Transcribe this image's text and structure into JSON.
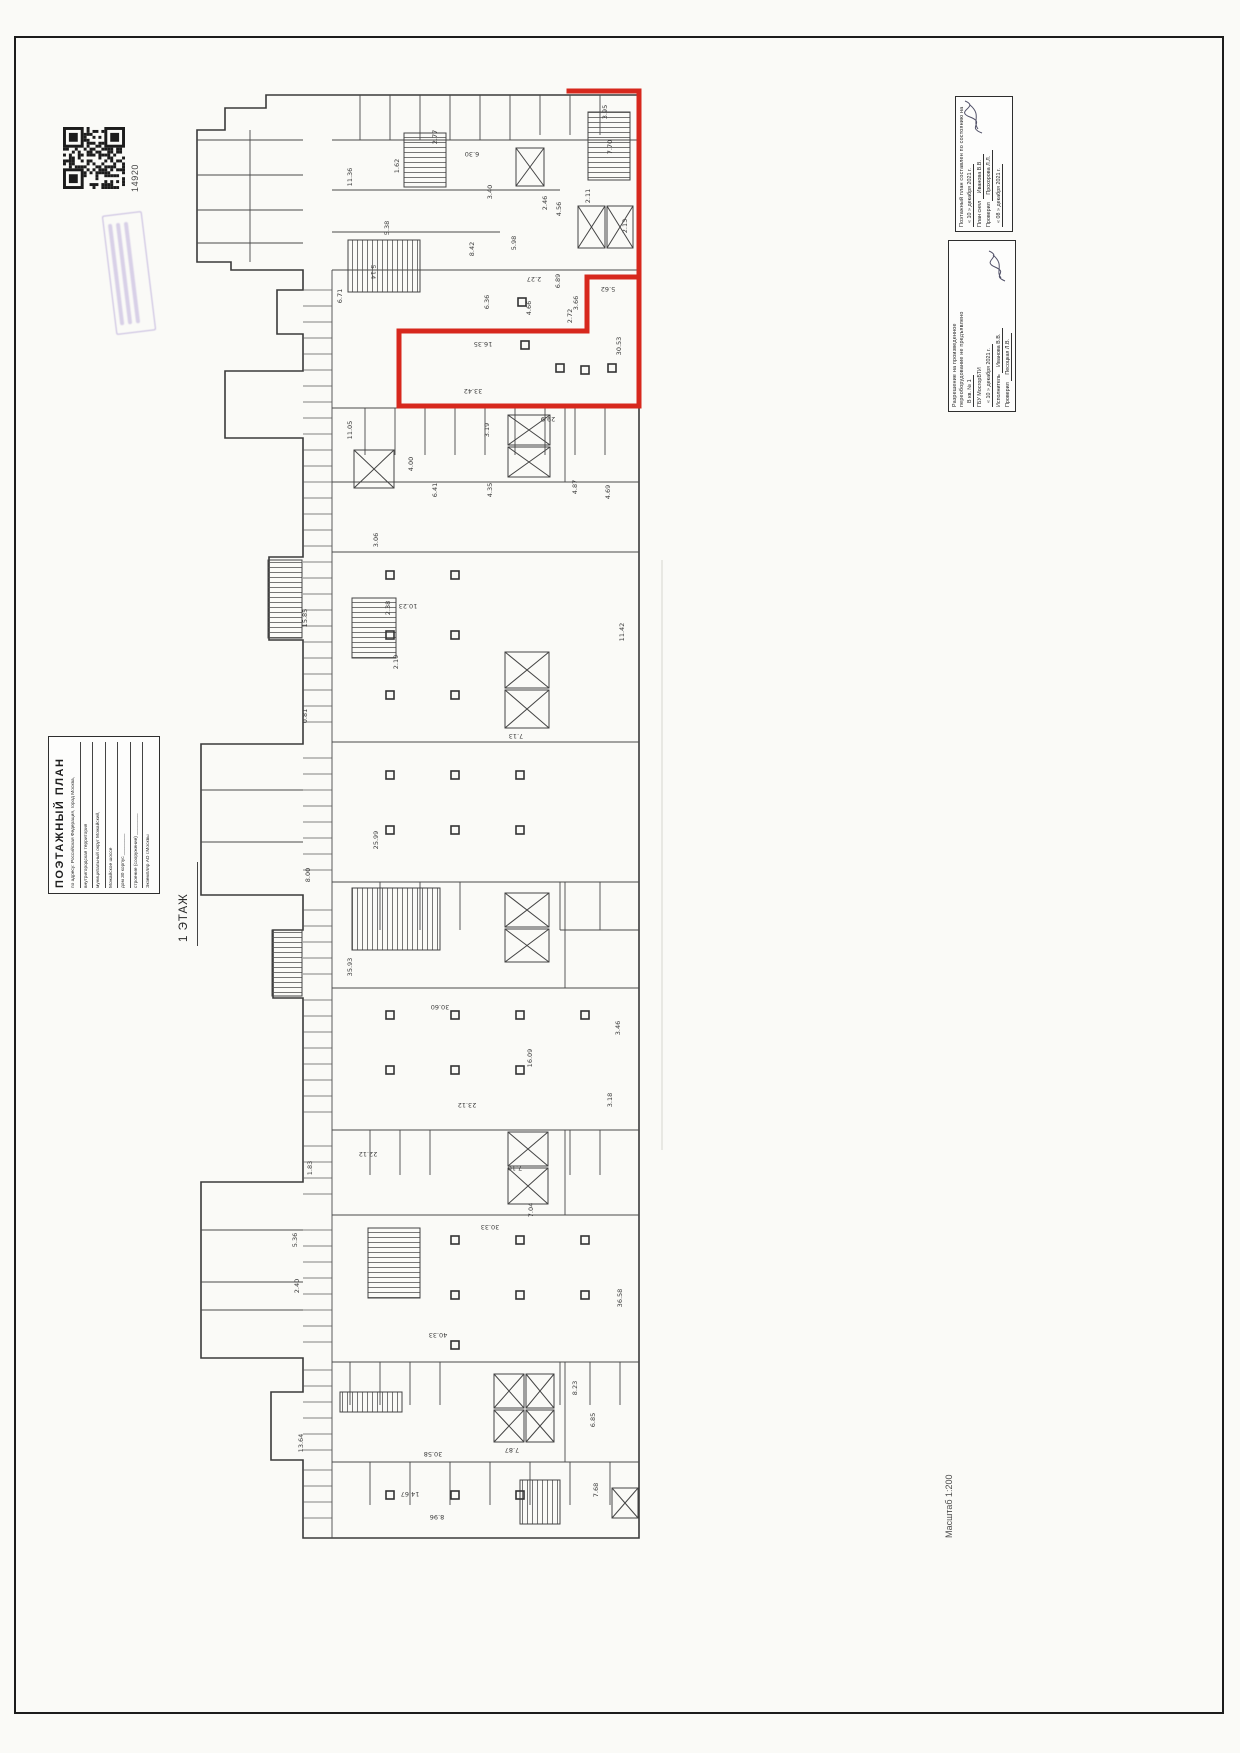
{
  "misc": {
    "barcode_number": "14920",
    "floor_label": "1 ЭТАЖ",
    "scale_label": "Масштаб 1:200"
  },
  "title_block": {
    "title": "ПОЭТАЖНЫЙ ПЛАН",
    "rows": [
      "по адресу: Российская Федерация, город Москва,",
      "внутригородская территория",
      "муниципальный округ Можайский,",
      "Можайское шоссе",
      "дом  30        корпус ________",
      "строение (сооружение) ________",
      "Экземпляр АО г.Москвы"
    ]
  },
  "survey": {
    "header": "Поэтажный план составлен по состоянию на",
    "date_line": "« 10 »  декабря  2021 г.",
    "rows": [
      {
        "label": "План снял",
        "name": "Иванова В.В."
      },
      {
        "label": "Проверил",
        "name": "Прохорова Л.Л."
      }
    ],
    "date_line2": "« 08 »  декабря  2021 г."
  },
  "permit": {
    "line1": "Разрешение на произведенное",
    "line2": "переоборудование не предъявлено",
    "line3": "В кв. № 1",
    "org": "ГБУ МосгорБТИ",
    "date_line": "« 10 »  декабря  2021 г.",
    "rows": [
      {
        "label": "Исполнитель",
        "name": "Иванова В.В."
      },
      {
        "label": "Проверил",
        "name": "Песоцкая Л.В."
      }
    ]
  },
  "plan": {
    "red_color": "#d7281d",
    "dims": [
      {
        "v": "3.95",
        "x": 607,
        "y": 112,
        "r": -90
      },
      {
        "v": "7.70",
        "x": 612,
        "y": 147,
        "r": -90
      },
      {
        "v": "2.13",
        "x": 627,
        "y": 226,
        "r": -90
      },
      {
        "v": "2.11",
        "x": 590,
        "y": 196,
        "r": -90
      },
      {
        "v": "4.56",
        "x": 561,
        "y": 209,
        "r": -90
      },
      {
        "v": "2.46",
        "x": 547,
        "y": 203,
        "r": -90
      },
      {
        "v": "3.40",
        "x": 492,
        "y": 192,
        "r": -90
      },
      {
        "v": "6.30",
        "x": 472,
        "y": 152,
        "r": 180
      },
      {
        "v": "2.77",
        "x": 437,
        "y": 137,
        "r": -90
      },
      {
        "v": "11.36",
        "x": 352,
        "y": 177,
        "r": -90
      },
      {
        "v": "1.62",
        "x": 399,
        "y": 166,
        "r": -90
      },
      {
        "v": "5.38",
        "x": 389,
        "y": 228,
        "r": -90
      },
      {
        "v": "8.42",
        "x": 474,
        "y": 249,
        "r": -90
      },
      {
        "v": "5.98",
        "x": 516,
        "y": 243,
        "r": -90
      },
      {
        "v": "6.36",
        "x": 489,
        "y": 302,
        "r": -90
      },
      {
        "v": "5.62",
        "x": 608,
        "y": 287,
        "r": 180
      },
      {
        "v": "2.27",
        "x": 534,
        "y": 277,
        "r": 180
      },
      {
        "v": "4.66",
        "x": 531,
        "y": 308,
        "r": -90
      },
      {
        "v": "2.72",
        "x": 572,
        "y": 316,
        "r": -90
      },
      {
        "v": "3.66",
        "x": 578,
        "y": 303,
        "r": -90
      },
      {
        "v": "6.89",
        "x": 560,
        "y": 281,
        "r": -90
      },
      {
        "v": "5.14",
        "x": 371,
        "y": 272,
        "r": 90
      },
      {
        "v": "6.71",
        "x": 342,
        "y": 296,
        "r": -90
      },
      {
        "v": "16.35",
        "x": 483,
        "y": 342,
        "r": 180
      },
      {
        "v": "33.42",
        "x": 473,
        "y": 389,
        "r": 180
      },
      {
        "v": "30.53",
        "x": 621,
        "y": 346,
        "r": -90
      },
      {
        "v": "29.9",
        "x": 548,
        "y": 417,
        "r": 180
      },
      {
        "v": "11.05",
        "x": 352,
        "y": 430,
        "r": -90
      },
      {
        "v": "3.19",
        "x": 489,
        "y": 430,
        "r": -90
      },
      {
        "v": "4.00",
        "x": 413,
        "y": 464,
        "r": -90
      },
      {
        "v": "6.41",
        "x": 437,
        "y": 490,
        "r": -90
      },
      {
        "v": "4.35",
        "x": 492,
        "y": 490,
        "r": -90
      },
      {
        "v": "4.87",
        "x": 577,
        "y": 487,
        "r": -90
      },
      {
        "v": "4.69",
        "x": 610,
        "y": 492,
        "r": -90
      },
      {
        "v": "3.06",
        "x": 378,
        "y": 540,
        "r": -90
      },
      {
        "v": "2.38",
        "x": 390,
        "y": 608,
        "r": -90
      },
      {
        "v": "15.85",
        "x": 307,
        "y": 618,
        "r": -90
      },
      {
        "v": "10.23",
        "x": 408,
        "y": 604,
        "r": 180
      },
      {
        "v": "2.19",
        "x": 398,
        "y": 662,
        "r": -90
      },
      {
        "v": "0.81",
        "x": 307,
        "y": 716,
        "r": -90
      },
      {
        "v": "7.13",
        "x": 516,
        "y": 734,
        "r": 180
      },
      {
        "v": "11.42",
        "x": 624,
        "y": 632,
        "r": -90
      },
      {
        "v": "25.99",
        "x": 378,
        "y": 840,
        "r": -90
      },
      {
        "v": "8.00",
        "x": 310,
        "y": 875,
        "r": -90
      },
      {
        "v": "35.93",
        "x": 352,
        "y": 967,
        "r": -90
      },
      {
        "v": "30.60",
        "x": 440,
        "y": 1005,
        "r": 180
      },
      {
        "v": "3.46",
        "x": 620,
        "y": 1028,
        "r": -90
      },
      {
        "v": "23.12",
        "x": 467,
        "y": 1103,
        "r": 180
      },
      {
        "v": "16.09",
        "x": 532,
        "y": 1058,
        "r": -90
      },
      {
        "v": "3.18",
        "x": 612,
        "y": 1100,
        "r": -90
      },
      {
        "v": "22.12",
        "x": 368,
        "y": 1152,
        "r": 180
      },
      {
        "v": "7.10",
        "x": 515,
        "y": 1166,
        "r": 180
      },
      {
        "v": "1.83",
        "x": 312,
        "y": 1168,
        "r": -90
      },
      {
        "v": "7.04",
        "x": 533,
        "y": 1210,
        "r": -90
      },
      {
        "v": "30.33",
        "x": 490,
        "y": 1225,
        "r": 180
      },
      {
        "v": "36.58",
        "x": 622,
        "y": 1298,
        "r": -90
      },
      {
        "v": "40.33",
        "x": 438,
        "y": 1333,
        "r": 180
      },
      {
        "v": "8.23",
        "x": 577,
        "y": 1388,
        "r": -90
      },
      {
        "v": "7.87",
        "x": 512,
        "y": 1448,
        "r": 180
      },
      {
        "v": "6.85",
        "x": 595,
        "y": 1420,
        "r": -90
      },
      {
        "v": "30.58",
        "x": 433,
        "y": 1452,
        "r": 180
      },
      {
        "v": "13.64",
        "x": 303,
        "y": 1443,
        "r": -90
      },
      {
        "v": "14.67",
        "x": 410,
        "y": 1492,
        "r": 180
      },
      {
        "v": "8.96",
        "x": 437,
        "y": 1515,
        "r": 180
      },
      {
        "v": "7.68",
        "x": 598,
        "y": 1490,
        "r": -90
      },
      {
        "v": "5.36",
        "x": 297,
        "y": 1240,
        "r": -90
      },
      {
        "v": "2.40",
        "x": 299,
        "y": 1286,
        "r": -90
      }
    ]
  }
}
